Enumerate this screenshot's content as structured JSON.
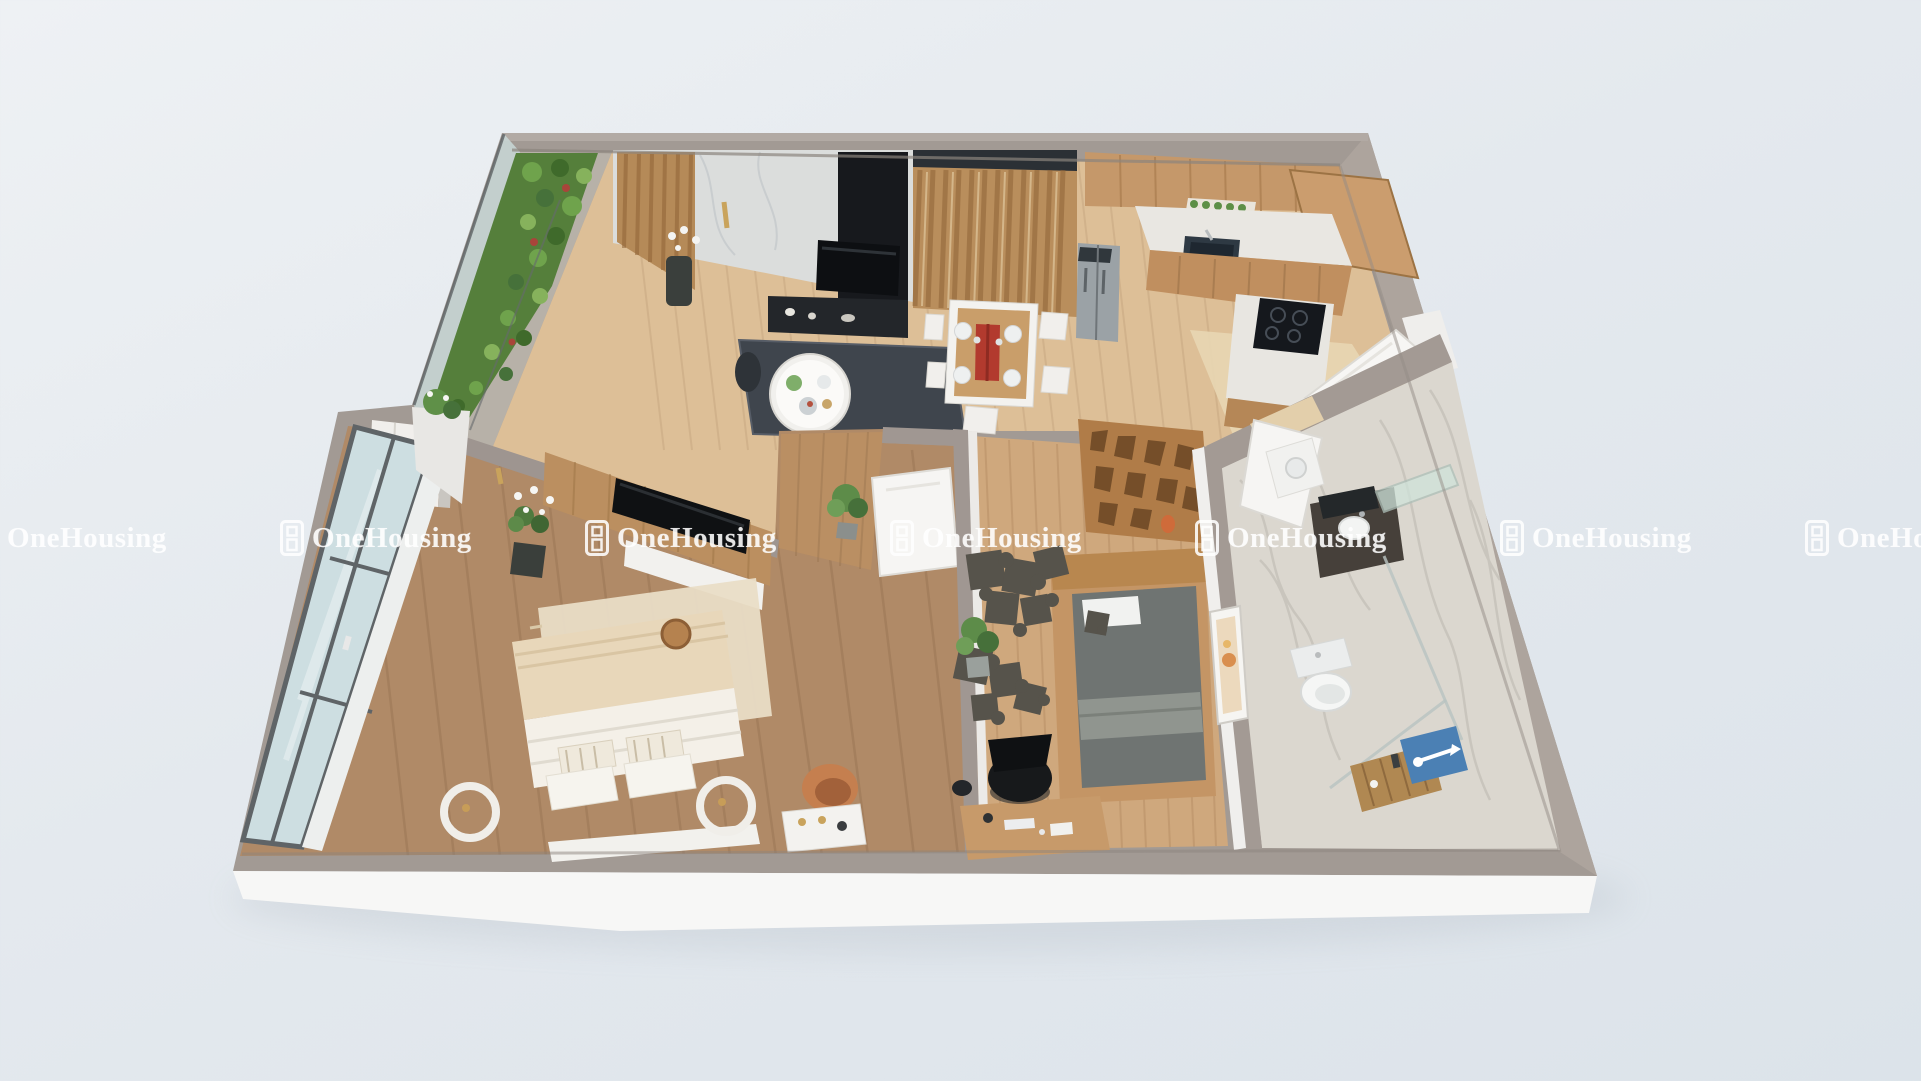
{
  "brand": {
    "watermark_text": "OneHousing",
    "watermark_repeat_count": 7,
    "logo_icon": "onehousing-window-logo-icon",
    "watermark_color": "#ffffff"
  },
  "scene": {
    "type": "3d-apartment-floor-plan-render",
    "view": "isometric-top-down",
    "rooms": [
      "balcony",
      "living-room",
      "dining-area",
      "kitchen",
      "entry",
      "master-bedroom",
      "second-bedroom-study",
      "bathroom"
    ],
    "palette": {
      "background": "#e3e8ee",
      "wall_gray": "#a29a94",
      "wall_fascia": "#f7f7f6",
      "wood_floor_light": "#ddbf97",
      "wood_floor_dark": "#b08a67",
      "wood_floor_mid": "#cfa87d",
      "slat_wood": "#b98e5c",
      "marble_wall": "#dbdddc",
      "rug_navy": "#3f454d",
      "accent_red": "#b23a2e",
      "mat_blue": "#4b80b4",
      "greenery": "#557f3b",
      "bath_marble": "#dbd7cf"
    }
  }
}
